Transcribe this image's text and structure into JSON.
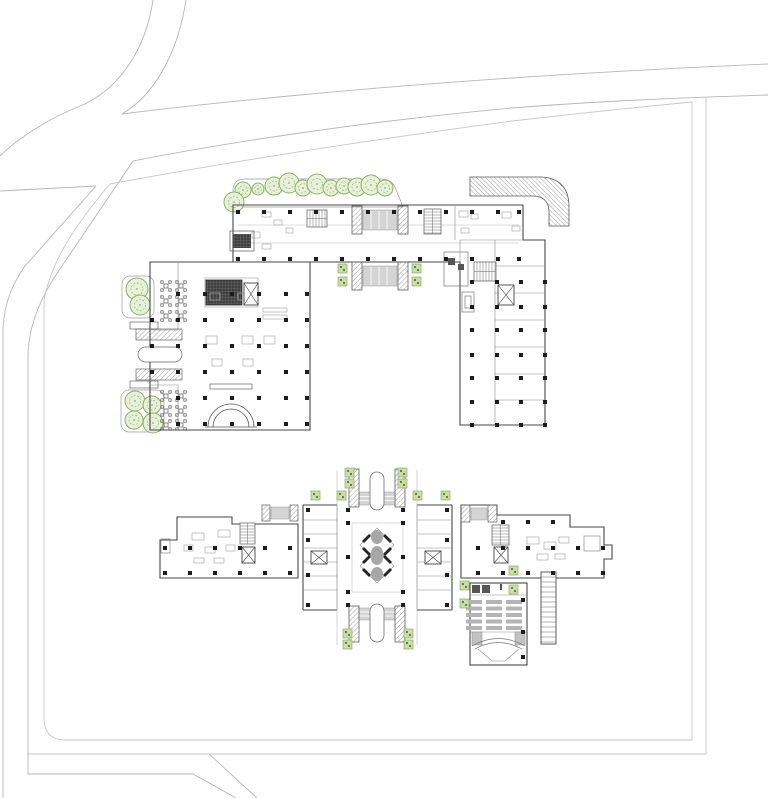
{
  "canvas": {
    "width": 768,
    "height": 798,
    "background": "#ffffff"
  },
  "drawing_title": "",
  "colors": {
    "road": "#b6b6b6",
    "boundary": "#c6c6c6",
    "wall": "#474747",
    "wall_light": "#8c8c8c",
    "faint": "#bdbdbd",
    "column": "#1c1c1c",
    "tree_stroke": "#8ab163",
    "tree_fill": "#e7f0da",
    "planter_fill": "#ccdcab",
    "planter_stroke": "#8fa868",
    "planter_dot": "#5d7434",
    "canopy_fill": "#d4d4d4",
    "canopy_stroke": "#9a9a9a",
    "seat": "#b4b4b4",
    "petal": "#a7a7a7",
    "escalator": "#222222",
    "furniture": "#ababab",
    "glyph": "#6b6b6b"
  },
  "upper_building": {
    "trees": [
      [
        243,
        190,
        8
      ],
      [
        258,
        189,
        6
      ],
      [
        274,
        186,
        9
      ],
      [
        289,
        183,
        10
      ],
      [
        303,
        188,
        8
      ],
      [
        317,
        184,
        10
      ],
      [
        331,
        188,
        8
      ],
      [
        344,
        186,
        8
      ],
      [
        357,
        187,
        9
      ],
      [
        371,
        185,
        10
      ],
      [
        385,
        188,
        8
      ],
      [
        234,
        202,
        10
      ],
      [
        137,
        289,
        11
      ],
      [
        140,
        305,
        10
      ],
      [
        135,
        401,
        10
      ],
      [
        152,
        405,
        9
      ],
      [
        134,
        420,
        9
      ],
      [
        153,
        423,
        10
      ]
    ],
    "columns": [
      [
        238,
        212
      ],
      [
        264,
        212
      ],
      [
        290,
        212
      ],
      [
        316,
        212
      ],
      [
        342,
        212
      ],
      [
        368,
        212
      ],
      [
        394,
        212
      ],
      [
        420,
        212
      ],
      [
        446,
        212
      ],
      [
        472,
        212
      ],
      [
        498,
        212
      ],
      [
        519,
        212
      ],
      [
        238,
        259
      ],
      [
        264,
        259
      ],
      [
        290,
        259
      ],
      [
        316,
        259
      ],
      [
        342,
        259
      ],
      [
        368,
        259
      ],
      [
        394,
        259
      ],
      [
        420,
        259
      ],
      [
        446,
        259
      ],
      [
        472,
        259
      ],
      [
        498,
        259
      ],
      [
        519,
        259
      ],
      [
        178,
        294
      ],
      [
        205,
        294
      ],
      [
        232,
        294
      ],
      [
        259,
        294
      ],
      [
        286,
        294
      ],
      [
        307,
        294
      ],
      [
        178,
        320
      ],
      [
        205,
        320
      ],
      [
        232,
        320
      ],
      [
        259,
        320
      ],
      [
        286,
        320
      ],
      [
        307,
        320
      ],
      [
        178,
        346
      ],
      [
        205,
        346
      ],
      [
        232,
        346
      ],
      [
        259,
        346
      ],
      [
        286,
        346
      ],
      [
        307,
        346
      ],
      [
        178,
        372
      ],
      [
        205,
        372
      ],
      [
        232,
        372
      ],
      [
        259,
        372
      ],
      [
        286,
        372
      ],
      [
        307,
        372
      ],
      [
        178,
        398
      ],
      [
        205,
        398
      ],
      [
        232,
        398
      ],
      [
        259,
        398
      ],
      [
        286,
        398
      ],
      [
        307,
        398
      ],
      [
        178,
        424
      ],
      [
        205,
        424
      ],
      [
        232,
        424
      ],
      [
        259,
        424
      ],
      [
        286,
        424
      ],
      [
        307,
        424
      ],
      [
        152,
        320
      ],
      [
        152,
        346
      ],
      [
        152,
        372
      ],
      [
        472,
        282
      ],
      [
        497,
        282
      ],
      [
        521,
        282
      ],
      [
        545,
        282
      ],
      [
        472,
        307
      ],
      [
        497,
        307
      ],
      [
        521,
        307
      ],
      [
        545,
        307
      ],
      [
        472,
        330
      ],
      [
        497,
        330
      ],
      [
        521,
        330
      ],
      [
        545,
        330
      ],
      [
        472,
        355
      ],
      [
        497,
        355
      ],
      [
        521,
        355
      ],
      [
        545,
        355
      ],
      [
        472,
        378
      ],
      [
        497,
        378
      ],
      [
        521,
        378
      ],
      [
        545,
        378
      ],
      [
        472,
        402
      ],
      [
        497,
        402
      ],
      [
        521,
        402
      ],
      [
        545,
        402
      ],
      [
        472,
        425
      ],
      [
        497,
        425
      ],
      [
        521,
        425
      ],
      [
        545,
        425
      ]
    ],
    "tables": [
      [
        166,
        286
      ],
      [
        181,
        286
      ],
      [
        166,
        301
      ],
      [
        181,
        301
      ],
      [
        166,
        316
      ],
      [
        181,
        316
      ],
      [
        166,
        396
      ],
      [
        181,
        396
      ],
      [
        166,
        411
      ],
      [
        181,
        411
      ],
      [
        166,
        425
      ],
      [
        181,
        425
      ]
    ],
    "planters": [
      [
        338,
        264
      ],
      [
        338,
        277
      ],
      [
        412,
        264
      ],
      [
        412,
        277
      ]
    ],
    "furniture": [
      [
        262,
        212,
        9,
        5
      ],
      [
        274,
        220,
        8,
        5
      ],
      [
        252,
        232,
        8,
        6
      ],
      [
        262,
        244,
        9,
        5
      ],
      [
        286,
        228,
        7,
        5
      ],
      [
        459,
        211,
        9,
        6
      ],
      [
        471,
        214,
        7,
        5
      ],
      [
        502,
        212,
        9,
        6
      ],
      [
        512,
        226,
        8,
        5
      ],
      [
        461,
        228,
        8,
        5
      ],
      [
        210,
        293,
        10,
        7
      ],
      [
        238,
        293,
        10,
        7
      ],
      [
        206,
        336,
        11,
        8
      ],
      [
        242,
        336,
        11,
        8
      ],
      [
        264,
        336,
        11,
        8
      ],
      [
        212,
        359,
        10,
        7
      ],
      [
        243,
        359,
        10,
        7
      ],
      [
        263,
        308,
        24,
        4
      ],
      [
        263,
        315,
        24,
        4
      ]
    ],
    "stairs": [
      [
        307,
        210,
        20,
        17,
        "v"
      ],
      [
        424,
        209,
        17,
        25,
        "h"
      ],
      [
        474,
        262,
        22,
        19,
        "v"
      ]
    ],
    "elevators": [
      [
        244,
        283,
        14,
        22
      ],
      [
        498,
        285,
        16,
        20
      ]
    ]
  },
  "lower_building": {
    "planters": [
      [
        345,
        468
      ],
      [
        345,
        479
      ],
      [
        398,
        468
      ],
      [
        398,
        479
      ],
      [
        311,
        491
      ],
      [
        337,
        491
      ],
      [
        413,
        491
      ],
      [
        441,
        491
      ],
      [
        343,
        629
      ],
      [
        343,
        640
      ],
      [
        404,
        629
      ],
      [
        404,
        640
      ],
      [
        460,
        581
      ],
      [
        460,
        599
      ],
      [
        509,
        566
      ],
      [
        509,
        585
      ]
    ],
    "columns": [
      [
        308,
        510
      ],
      [
        348,
        510
      ],
      [
        403,
        510
      ],
      [
        447,
        510
      ],
      [
        308,
        540
      ],
      [
        308,
        575
      ],
      [
        447,
        540
      ],
      [
        447,
        575
      ],
      [
        308,
        605
      ],
      [
        348,
        605
      ],
      [
        403,
        605
      ],
      [
        447,
        605
      ],
      [
        348,
        523
      ],
      [
        403,
        523
      ],
      [
        348,
        557
      ],
      [
        403,
        557
      ],
      [
        348,
        592
      ],
      [
        403,
        592
      ],
      [
        165,
        548
      ],
      [
        190,
        548
      ],
      [
        215,
        548
      ],
      [
        240,
        548
      ],
      [
        265,
        548
      ],
      [
        290,
        548
      ],
      [
        165,
        573
      ],
      [
        190,
        573
      ],
      [
        215,
        573
      ],
      [
        240,
        573
      ],
      [
        265,
        573
      ],
      [
        290,
        573
      ],
      [
        478,
        548
      ],
      [
        503,
        548
      ],
      [
        528,
        548
      ],
      [
        553,
        548
      ],
      [
        578,
        548
      ],
      [
        603,
        548
      ],
      [
        478,
        573
      ],
      [
        503,
        573
      ],
      [
        528,
        573
      ],
      [
        553,
        573
      ],
      [
        578,
        573
      ],
      [
        603,
        573
      ],
      [
        503,
        522
      ],
      [
        528,
        522
      ],
      [
        553,
        522
      ],
      [
        523,
        600
      ],
      [
        523,
        632
      ],
      [
        523,
        657
      ]
    ],
    "furniture": [
      [
        192,
        533,
        12,
        7
      ],
      [
        218,
        530,
        12,
        7
      ],
      [
        184,
        545,
        9,
        6
      ],
      [
        205,
        547,
        10,
        6
      ],
      [
        226,
        545,
        9,
        6
      ],
      [
        194,
        558,
        10,
        5
      ],
      [
        214,
        558,
        10,
        5
      ],
      [
        527,
        537,
        12,
        7
      ],
      [
        544,
        542,
        12,
        7
      ],
      [
        559,
        537,
        10,
        6
      ],
      [
        537,
        554,
        11,
        6
      ],
      [
        555,
        554,
        10,
        5
      ]
    ],
    "stairs": [
      [
        240,
        523,
        15,
        21,
        "h"
      ],
      [
        492,
        525,
        17,
        20,
        "h"
      ]
    ],
    "elevators": [
      [
        242,
        547,
        13,
        16
      ],
      [
        494,
        547,
        14,
        16
      ],
      [
        311,
        551,
        16,
        13
      ],
      [
        425,
        551,
        16,
        13
      ]
    ],
    "auditorium_seats": {
      "section_x": [
        466,
        486,
        506
      ],
      "row_y": [
        600,
        606.5,
        613,
        619.5,
        626
      ],
      "w": 16,
      "h": 4
    },
    "ladder": {
      "x": 541,
      "y": 572,
      "w": 15,
      "h": 72,
      "step": 5
    }
  }
}
